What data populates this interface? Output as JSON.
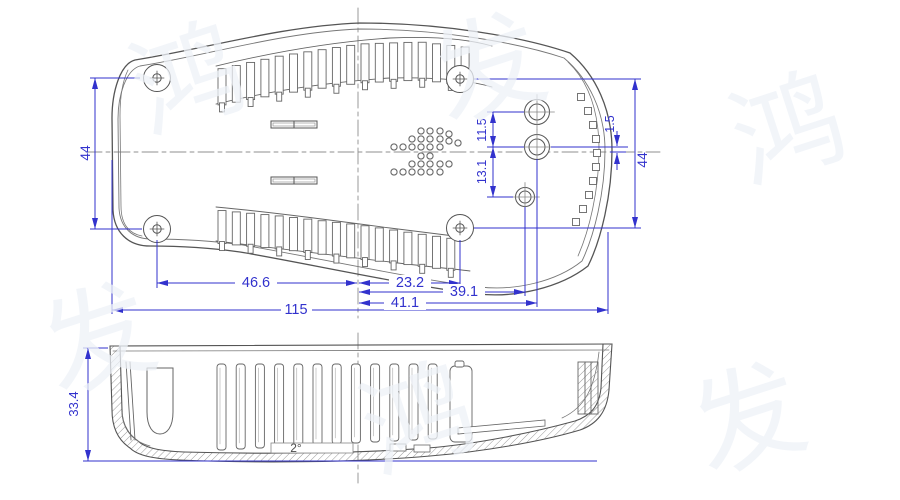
{
  "watermark": {
    "glyphs": [
      "鸿",
      "发",
      "鸿",
      "发",
      "鸿",
      "发"
    ]
  },
  "colors": {
    "dimension_blue": "#3232cd",
    "line_gray": "#5a5a5a"
  },
  "top_view": {
    "dims": {
      "left_height": "44",
      "right_height": "44",
      "screw_to_center_left": "46.6",
      "center_to_screw_right": "23.2",
      "center_to_small_boss": "39.1",
      "center_to_boss_column": "41.1",
      "overall_length": "115",
      "boss_gap_upper": "11.5",
      "boss_gap_lower": "13.1",
      "boss_center_offset": "1.5"
    }
  },
  "side_view": {
    "dims": {
      "overall_height": "33.4",
      "draft_angle": "2°"
    }
  }
}
